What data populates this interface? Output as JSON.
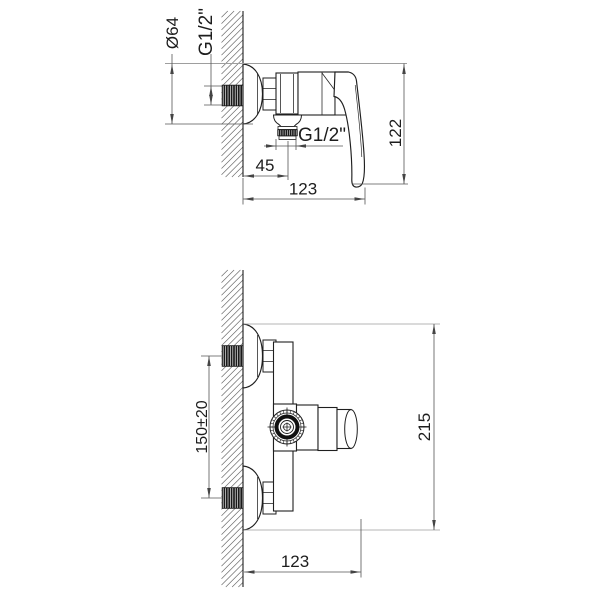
{
  "drawing": {
    "type": "technical-installation-drawing",
    "subject": "wall-mounted single-lever shower mixer, side view and plan view with dimensions",
    "units": "mm",
    "side_view": {
      "labels": {
        "escutcheon_diameter": "Ø64",
        "wall_thread": "G1/2\"",
        "body_height": "122",
        "outlet_thread": "G1/2\"",
        "outlet_offset": "45",
        "body_width": "123"
      }
    },
    "plan_view": {
      "labels": {
        "inlet_spacing": "150±20",
        "overall_height": "215",
        "body_width": "123"
      }
    }
  },
  "colors": {
    "background": "#ffffff",
    "object_line": "#1f1f1f",
    "dimension_line": "#555555",
    "tangent_line": "#9e9e9e",
    "hatch_line": "#6e6e6e",
    "thread_fill": "#1a1a1a"
  }
}
